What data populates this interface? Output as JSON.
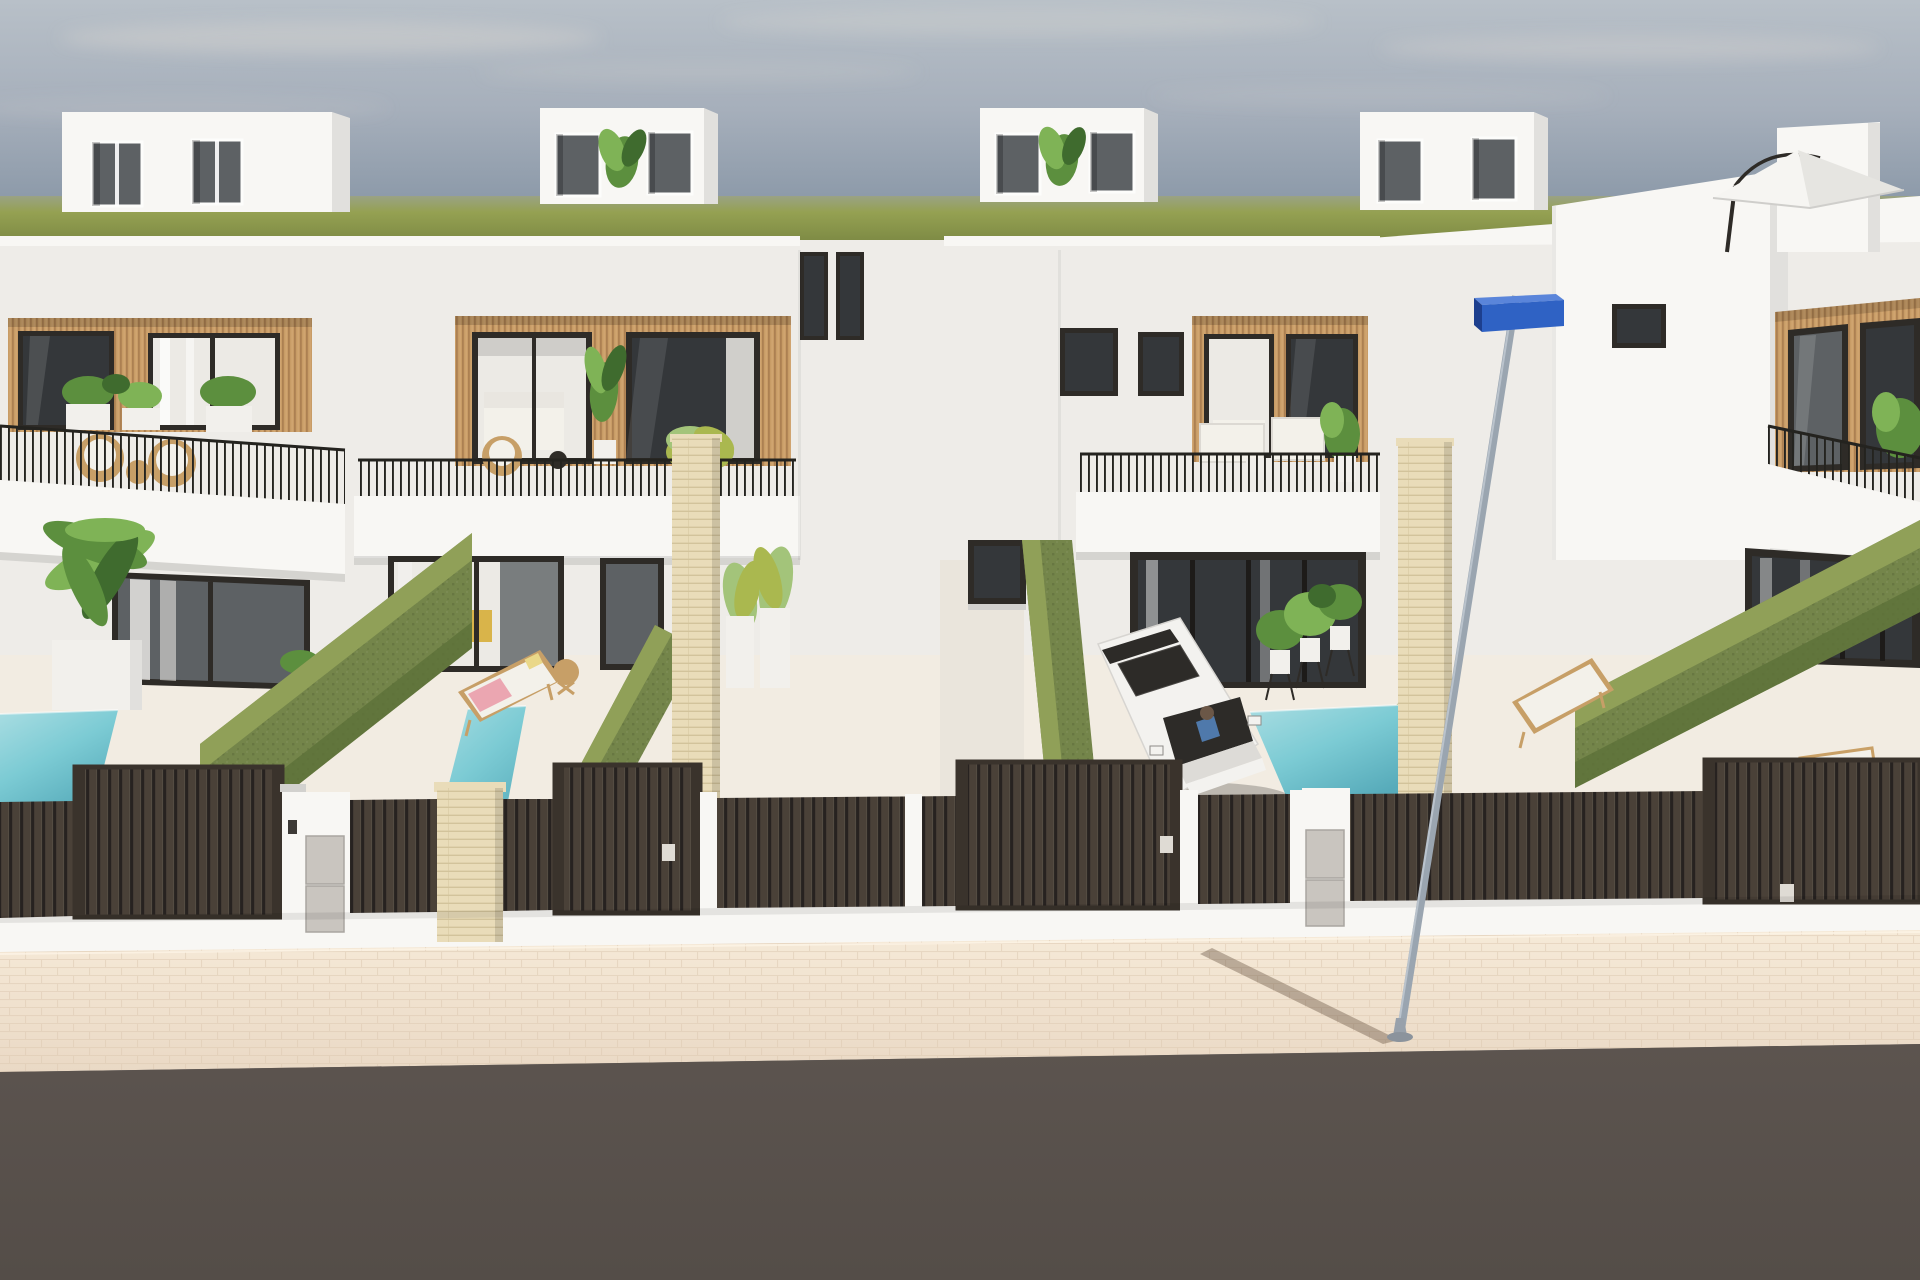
{
  "meta": {
    "title": "Aerial street-view 3D render of a row of modern white villas with private plunge pools",
    "render_style": "architectural visualization"
  },
  "palette": {
    "sky_top": "#b8c0c8",
    "sky_mid": "#a6afbb",
    "sky_low": "#8f9cab",
    "sky_horizon": "#8793a2",
    "cloud": "#e8e2d8",
    "field_haze": "#9aa284",
    "field_mid": "#95a152",
    "field_dark": "#7d8a44",
    "wall_base": "#eeece8",
    "wall_bright": "#f8f7f4",
    "wall_shade": "#e1e0dd",
    "wall_dark": "#d2d1ce",
    "wood_light": "#c89c66",
    "wood_dark": "#a2774a",
    "wood_hi": "#dcb27e",
    "frame_dark": "#2e2b27",
    "glass_dark": "#34373a",
    "glass_mid": "#5d6164",
    "glass_light": "#eceae5",
    "rail_dark": "#24231f",
    "hedge_top": "#90a058",
    "hedge_body": "#74854a",
    "hedge_dark": "#5d7038",
    "pool_light": "#a9dde2",
    "pool_mid": "#7ccbd4",
    "pool_deep": "#57abba",
    "fence_slat": "#4a4138",
    "fence_gap": "#272220",
    "fence_frame": "#3a332c",
    "fence_hi": "#5f564c",
    "stone_light": "#e9dcb9",
    "stone_line": "#cebf95",
    "walk_light": "#f6ead8",
    "walk_dark": "#ead9c5",
    "walk_line": "#ddc9b2",
    "road": "#5c544f",
    "road_dark": "#544d48",
    "pole": "#9aa5b0",
    "pole_hi": "#c8d0d8",
    "sign_front": "#2f62c4",
    "sign_top": "#5a85da",
    "sign_side": "#1d3f8e",
    "car_body": "#f3f2ef",
    "car_shade": "#dddbd7",
    "car_glass": "#2d2b28",
    "shirt_blue": "#4f79ab",
    "head_brown": "#6b5747",
    "wood_furn": "#c79f67",
    "cushion": "#f3f1ea",
    "towel_pink": "#eba6b1",
    "pillow_yellow": "#ead889",
    "chair_yellow": "#d9b44a",
    "leaf_dark": "#3f6b2e",
    "leaf_mid": "#5c8f3e",
    "leaf_light": "#7fb356",
    "leaf_yellow": "#aab84f",
    "leaf_pale": "#a3c47a",
    "planter": "#f2f0ec",
    "box_metal": "#c9c5bf"
  },
  "scene": {
    "sky": {
      "condition": "hazy sky with thin pale clouds",
      "bands": [
        "sky_top",
        "sky_mid",
        "sky_low",
        "sky_horizon"
      ]
    },
    "horizon": {
      "type": "flat olive-green field strip behind the roofline"
    },
    "street": {
      "sidewalk": "pale beige paved sidewalk",
      "road": "dark grey asphalt",
      "street_lamp_poles": 1,
      "street_signs": 1
    },
    "houses": [
      {
        "id": "villa-1",
        "position": "far left",
        "features": [
          "rooftop bulkhead with two windows",
          "upper terrace with rattan chairs and white planters",
          "wood-slat facade band",
          "black vertical-bar balcony railing",
          "dark framed sliding glass doors",
          "palm in white planter",
          "turquoise plunge pool"
        ]
      },
      {
        "id": "villa-2",
        "position": "center left",
        "features": [
          "rooftop bulkhead with plant",
          "wood-slat facade with two picture windows",
          "balcony wicker chair",
          "sliding glass doors",
          "sun lounger with pink towel",
          "round wooden side table",
          "turquoise plunge pool"
        ]
      },
      {
        "id": "villa-3",
        "position": "center right",
        "features": [
          "rooftop bulkhead with plant",
          "wood-slat facade",
          "balcony with white outdoor sofas",
          "recessed dark glass ground floor",
          "driveway with parked white car and driver",
          "three potted plants on stands",
          "turquoise plunge pool"
        ]
      },
      {
        "id": "villa-4",
        "position": "far right",
        "features": [
          "tall bright side volume",
          "rooftop chimney",
          "white cantilever parasol on roof terrace",
          "wood-slat facade",
          "curtained glass doors",
          "two sun loungers",
          "turquoise plunge pool"
        ]
      }
    ],
    "objects": {
      "plunge_pools": 4,
      "sun_loungers": 3,
      "parked_cars": 1,
      "street_lamps": 1,
      "street_signs": 1,
      "parasols": 1,
      "privacy_hedges": 5,
      "tall_entrance_gates": 4,
      "short_fence_panels": 7,
      "white_fence_pillars": 5,
      "travertine_pillars": 3,
      "utility_meter_stacks": 2,
      "house_number_plaques": 3
    }
  }
}
